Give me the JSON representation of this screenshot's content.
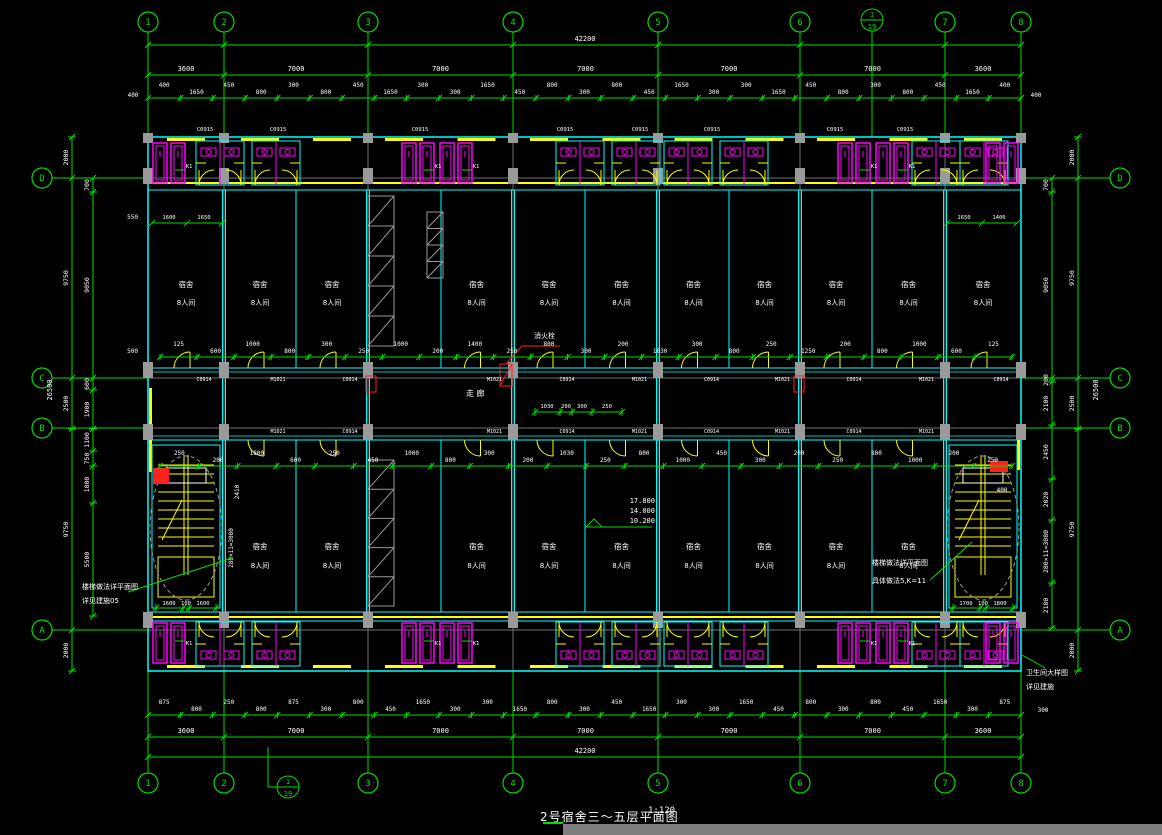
{
  "title_block": {
    "title": "2号宿舍三～五层平面图",
    "scale": "1:120"
  },
  "grid": {
    "columns": [
      "1",
      "2",
      "3",
      "4",
      "5",
      "6",
      "7",
      "8"
    ],
    "rows": [
      "D",
      "C",
      "B",
      "A"
    ],
    "detail_marker_top": "1",
    "detail_marker_bottom": "19"
  },
  "dimensions": {
    "total_width": "42200",
    "total_height": "26500",
    "bays": [
      "3600",
      "7000",
      "7000",
      "7000",
      "7000",
      "7000",
      "3600"
    ],
    "edge_offset": "400",
    "top_detail": [
      "400",
      "1650",
      "450",
      "800",
      "300",
      "800",
      "450",
      "1650",
      "300",
      "300",
      "1650",
      "450",
      "800",
      "300",
      "800",
      "450",
      "1650",
      "300",
      "300",
      "1650",
      "450",
      "800",
      "300",
      "800",
      "450",
      "1650",
      "400"
    ],
    "bottom_detail": [
      "875",
      "800",
      "250",
      "800",
      "875",
      "300",
      "800",
      "450",
      "1650",
      "300",
      "300",
      "1650",
      "800",
      "300",
      "450",
      "1650",
      "300",
      "300",
      "1650",
      "450",
      "800",
      "300",
      "800",
      "450",
      "1650",
      "300",
      "875"
    ],
    "left_outer": [
      "2000",
      "9750",
      "2500",
      "9750",
      "2000"
    ],
    "left_inner_top": [
      "700",
      "9050"
    ],
    "left_inner_mid": [
      "600",
      "1900"
    ],
    "left_inner_bot": [
      "1100",
      "750",
      "1800",
      "5500"
    ],
    "right_inner": [
      "700",
      "9050",
      "200",
      "2100",
      "2450",
      "2020",
      "280×11=3080",
      "2180"
    ],
    "right_outer": [
      "2000",
      "9750",
      "2500",
      "9750",
      "2000"
    ],
    "stair_left": [
      "1600",
      "100",
      "1600"
    ],
    "stair_right": [
      "1700",
      "100",
      "1800"
    ],
    "stair_rise": "280×11=3080",
    "stair_width": "2410",
    "hydrant_offset": "400",
    "wall_dim_top": "550",
    "wall_dim_bot": "500",
    "room_dim_left": [
      "1600",
      "1650"
    ],
    "room_dim_right": [
      "1650",
      "1400"
    ],
    "corridor_dims": [
      "1030",
      "200",
      "300",
      "250"
    ],
    "upper_interior": [
      "125",
      "600",
      "1000",
      "800",
      "300",
      "250",
      "1000",
      "200",
      "1400",
      "250",
      "800",
      "300",
      "200",
      "1030",
      "300",
      "800",
      "250",
      "1250",
      "200",
      "800",
      "1000",
      "600",
      "125"
    ],
    "lower_interior": [
      "250",
      "200",
      "1800",
      "600",
      "250",
      "450",
      "1000",
      "800",
      "300",
      "200",
      "1030",
      "250",
      "800",
      "1000",
      "450",
      "300",
      "200",
      "250",
      "800",
      "1000",
      "200",
      "250"
    ]
  },
  "rooms": {
    "dorm": "宿舍",
    "type": "8人间",
    "corridor": "走 廊"
  },
  "levels": [
    "17.800",
    "14.000",
    "10.200"
  ],
  "annotations": {
    "hydrant": "消火栓",
    "stair_note_left_1": "楼梯做法详平面图",
    "stair_note_left_2": "详见建施05",
    "stair_note_right_1": "楼梯做法详平面图",
    "stair_note_right_2": "具体做法5,K=11",
    "corner_note_1": "卫生间大样图",
    "corner_note_2": "详见建施"
  },
  "tags": {
    "window_tag": "C0915",
    "door_tag": "M1021",
    "door_tag2": "C0914",
    "fixture_tag": "K1"
  },
  "colors": {
    "grid": "#00dd00",
    "wall": "#00ffff",
    "window": "#ffff00",
    "fixture": "#ff00ff",
    "column": "#9a9a9a",
    "hydrant": "#ff2020",
    "text": "#ffffff",
    "centerline": "#6f6f6f"
  }
}
